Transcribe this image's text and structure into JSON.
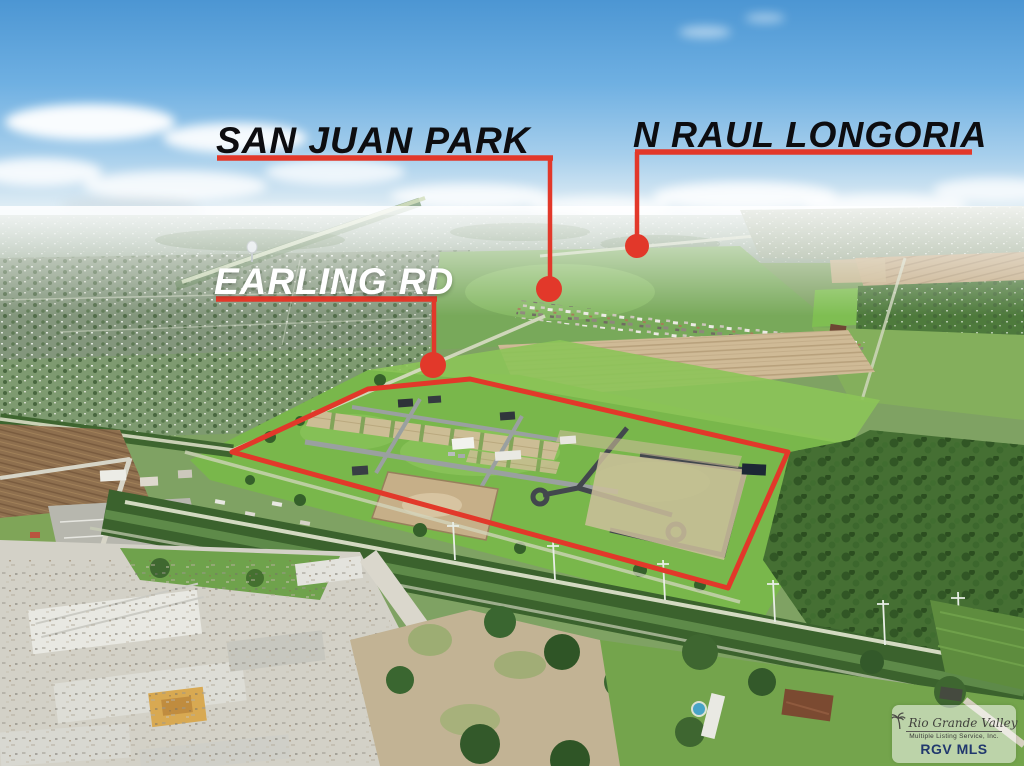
{
  "annotations": {
    "line_color": "#e2382a",
    "labels": {
      "san_juan_park": "SAN JUAN PARK",
      "n_raul_longoria": "N RAUL LONGORIA",
      "earling_rd": "EARLING RD"
    }
  },
  "watermark": {
    "org_name_script": "Rio Grande Valley",
    "org_name_sub": "Multiple Listing Service, Inc.",
    "org_abbr": "RGV MLS",
    "abbr_color": "#21386e"
  },
  "scene": {
    "sky_color": "#4c96d3",
    "grass_color": "#79b74b",
    "plowed_field_color": "#cfba96",
    "woods_color": "#456f33",
    "road_color": "#d8dcc4"
  }
}
